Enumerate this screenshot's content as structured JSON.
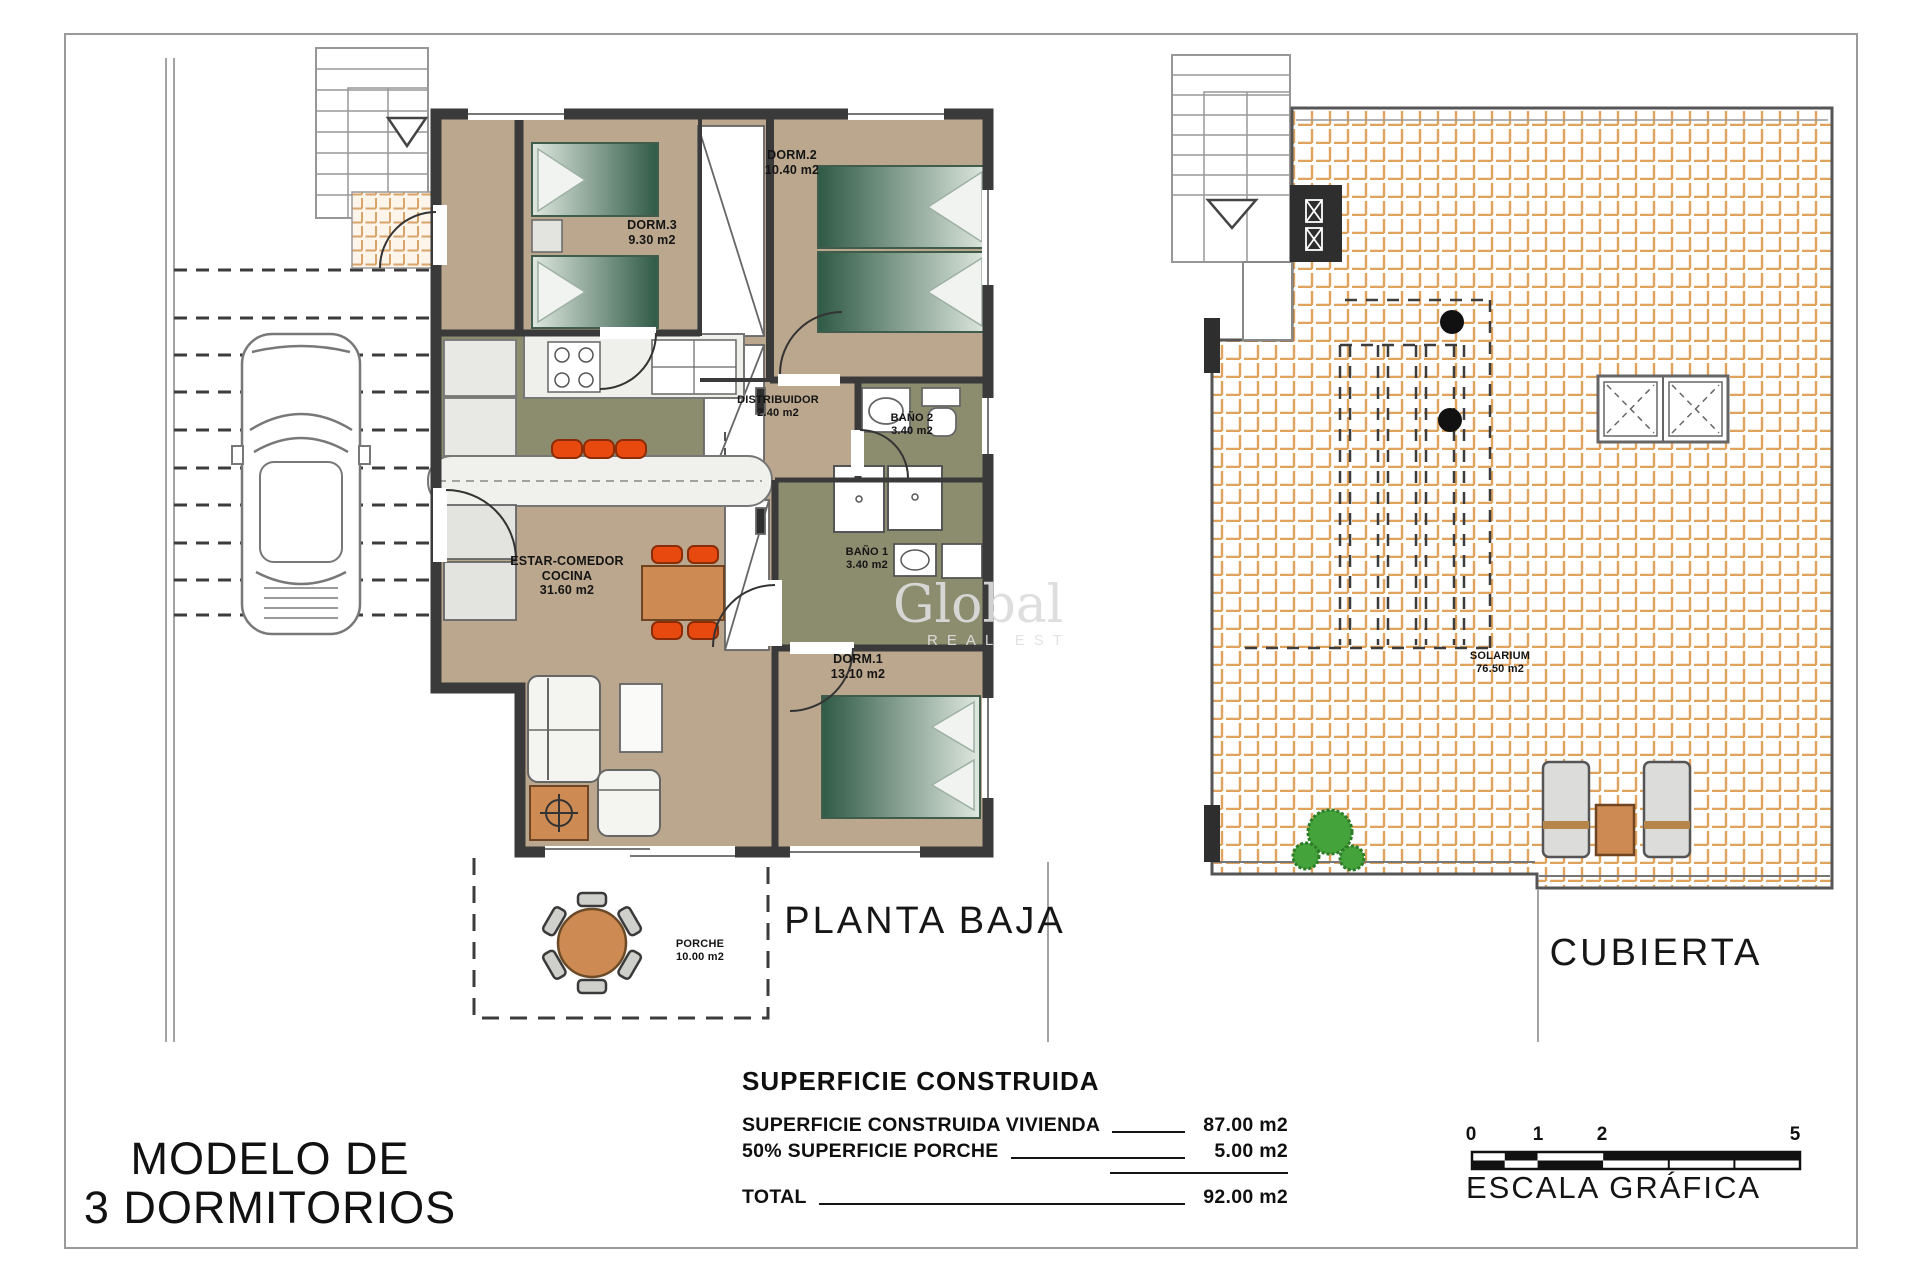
{
  "document": {
    "model_title_line1": "MODELO DE",
    "model_title_line2": "3 DORMITORIOS",
    "watermark_line1": "Global",
    "watermark_line2": "REAL EST"
  },
  "plans": {
    "ground": {
      "label": "PLANTA BAJA",
      "rooms": [
        {
          "name": "DORM.3",
          "area": "9.30 m2"
        },
        {
          "name": "DORM.2",
          "area": "10.40 m2"
        },
        {
          "name": "DISTRIBUIDOR",
          "area": "2.40 m2"
        },
        {
          "name": "BAÑO 2",
          "area": "3.40 m2"
        },
        {
          "name": "BAÑO 1",
          "area": "3.40 m2"
        },
        {
          "name": "DORM.1",
          "area": "13.10 m2"
        },
        {
          "name": "ESTAR-COMEDOR",
          "name2": "COCINA",
          "area": "31.60 m2"
        },
        {
          "name": "PORCHE",
          "area": "10.00 m2"
        }
      ]
    },
    "roof": {
      "label": "CUBIERTA",
      "rooms": [
        {
          "name": "SOLARIUM",
          "area": "76.50 m2"
        }
      ]
    }
  },
  "summary": {
    "title": "SUPERFICIE CONSTRUIDA",
    "rows": [
      {
        "label": "SUPERFICIE CONSTRUIDA VIVIENDA",
        "value": "87.00 m2"
      },
      {
        "label": "50% SUPERFICIE PORCHE",
        "value": "5.00 m2"
      },
      {
        "label": "TOTAL",
        "value": "92.00 m2"
      }
    ]
  },
  "scale_bar": {
    "label": "ESCALA GRÁFICA",
    "ticks": [
      "0",
      "1",
      "2",
      "5"
    ],
    "colors": {
      "dark": "#111111",
      "light": "#ffffff"
    }
  },
  "palette": {
    "wall": "#3a3a3a",
    "floor_beige": "#baa78d",
    "floor_olive": "#8c8c6f",
    "tile_grout_orange": "#e0a35e",
    "furniture_orange": "#e8490f",
    "wood_brown": "#cd8a52",
    "bed_green": "#2f5a45",
    "plant_green": "#45a33b"
  }
}
